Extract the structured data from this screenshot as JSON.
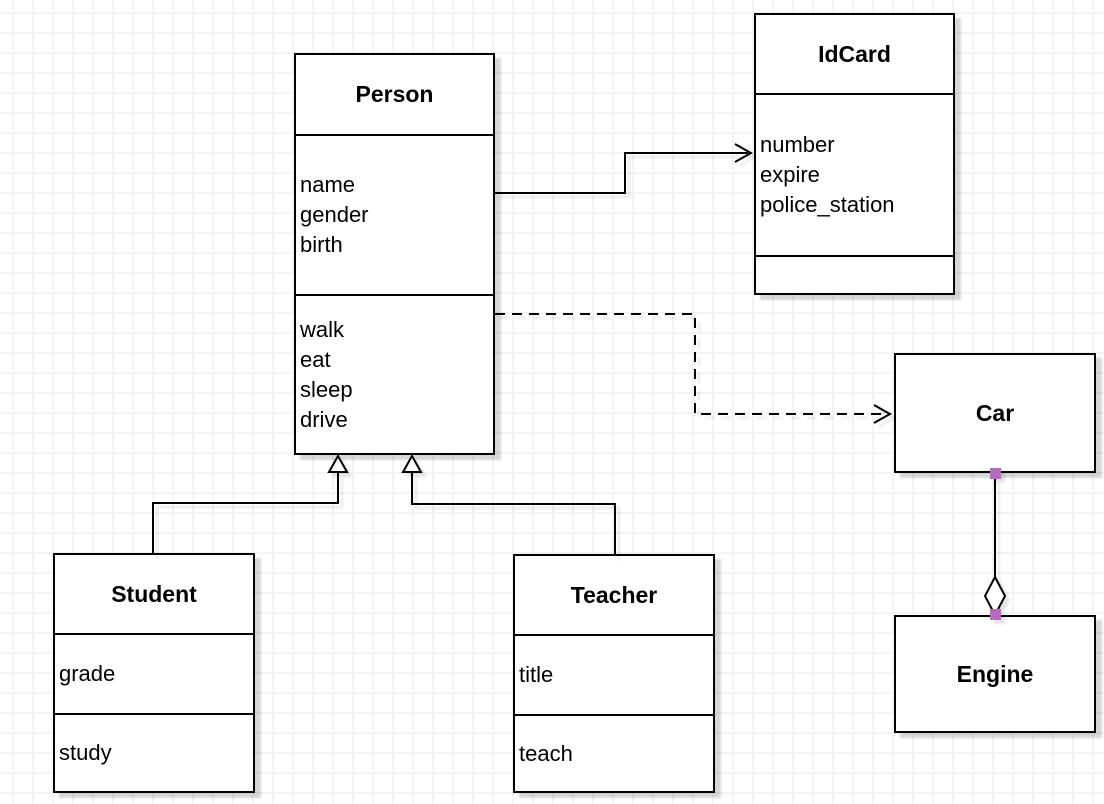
{
  "diagram": {
    "type": "uml-class-diagram",
    "canvas": {
      "width": 1104,
      "height": 804,
      "background": "#ffffff",
      "grid_color": "#f3f3f3",
      "grid_size": 20
    },
    "colors": {
      "stroke": "#000000",
      "box_fill": "#ffffff",
      "handle": "#b76bbd"
    },
    "classes": {
      "person": {
        "title": "Person",
        "attributes": [
          "name",
          "gender",
          "birth"
        ],
        "methods": [
          "walk",
          "eat",
          "sleep",
          "drive"
        ]
      },
      "idcard": {
        "title": "IdCard",
        "attributes": [
          "number",
          "expire",
          "police_station"
        ],
        "methods": []
      },
      "car": {
        "title": "Car",
        "attributes": [],
        "methods": []
      },
      "engine": {
        "title": "Engine",
        "attributes": [],
        "methods": []
      },
      "student": {
        "title": "Student",
        "attributes": [
          "grade"
        ],
        "methods": [
          "study"
        ]
      },
      "teacher": {
        "title": "Teacher",
        "attributes": [
          "title"
        ],
        "methods": [
          "teach"
        ]
      }
    },
    "relationships": [
      {
        "from": "Person",
        "to": "IdCard",
        "type": "association",
        "line": "solid",
        "arrowhead": "open"
      },
      {
        "from": "Person",
        "to": "Car",
        "type": "dependency",
        "line": "dashed",
        "arrowhead": "open"
      },
      {
        "from": "Student",
        "to": "Person",
        "type": "generalization",
        "line": "solid",
        "arrowhead": "hollow-triangle"
      },
      {
        "from": "Teacher",
        "to": "Person",
        "type": "generalization",
        "line": "solid",
        "arrowhead": "hollow-triangle"
      },
      {
        "from": "Car",
        "to": "Engine",
        "type": "aggregation",
        "line": "solid",
        "arrowhead": "hollow-diamond"
      }
    ]
  }
}
